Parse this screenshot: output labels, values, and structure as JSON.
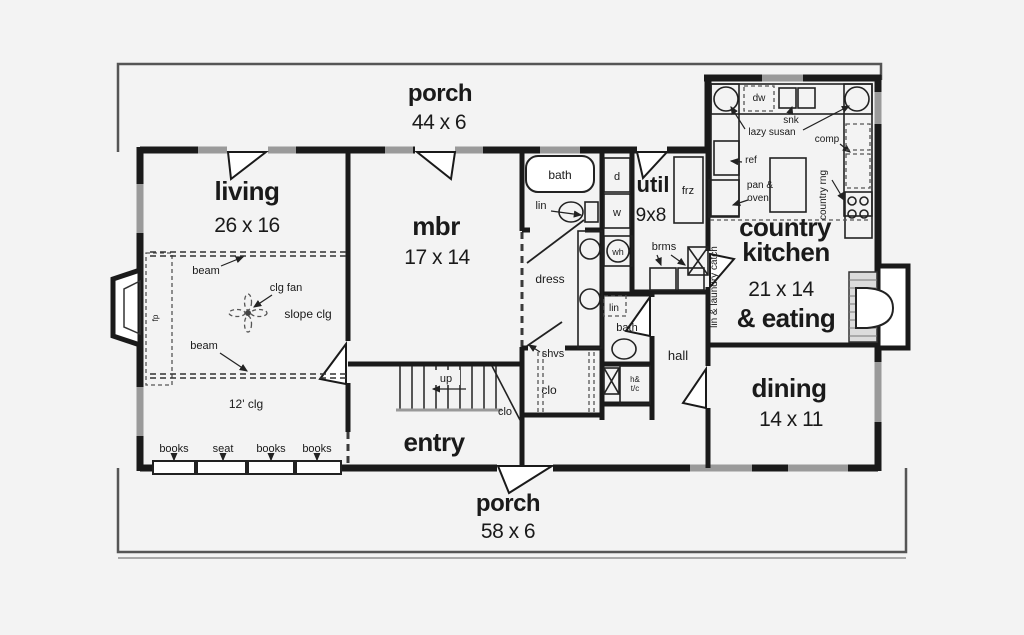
{
  "colors": {
    "ink": "#1a1a1a",
    "win": "#9a9a9a",
    "bg": "#f3f3f3"
  },
  "rooms": {
    "porch_top": {
      "name": "porch",
      "dims": "44 x 6"
    },
    "living": {
      "name": "living",
      "dims": "26 x 16"
    },
    "mbr": {
      "name": "mbr",
      "dims": "17 x 14"
    },
    "util": {
      "name": "util",
      "dims": "9x8"
    },
    "kitchen": {
      "line1": "country",
      "line2": "kitchen",
      "dims": "21 x 14",
      "line3": "& eating"
    },
    "dining": {
      "name": "dining",
      "dims": "14 x 11"
    },
    "entry": {
      "name": "entry"
    },
    "hall": {
      "name": "hall"
    },
    "porch_bottom": {
      "name": "porch",
      "dims": "58 x 6"
    }
  },
  "fixtures": {
    "bath": "bath",
    "lin": "lin",
    "dryer": "d",
    "washer": "w",
    "water_heater": "wh",
    "freezer": "frz",
    "brooms": "brms",
    "laundry_chute": "lin & laundry catch",
    "dress": "dress",
    "lin2": "lin",
    "bath2": "bath",
    "shelves": "shvs",
    "closet": "clo",
    "hall_closet_line1": "h&",
    "hall_closet_line2": "t/c",
    "stair_up": "up",
    "stair_closet": "clo",
    "dishwasher": "dw",
    "sink": "snk",
    "lazy_susan": "lazy susan",
    "compactor": "comp",
    "refrigerator": "ref",
    "pan_oven_line1": "pan &",
    "pan_oven_line2": "oven",
    "country_range": "country rng",
    "fireplace": "fp"
  },
  "ceiling": {
    "beam_top": "beam",
    "beam_bottom": "beam",
    "fan": "clg fan",
    "slope": "slope clg",
    "height": "12' clg"
  },
  "builtins": [
    "books",
    "seat",
    "books",
    "books"
  ]
}
